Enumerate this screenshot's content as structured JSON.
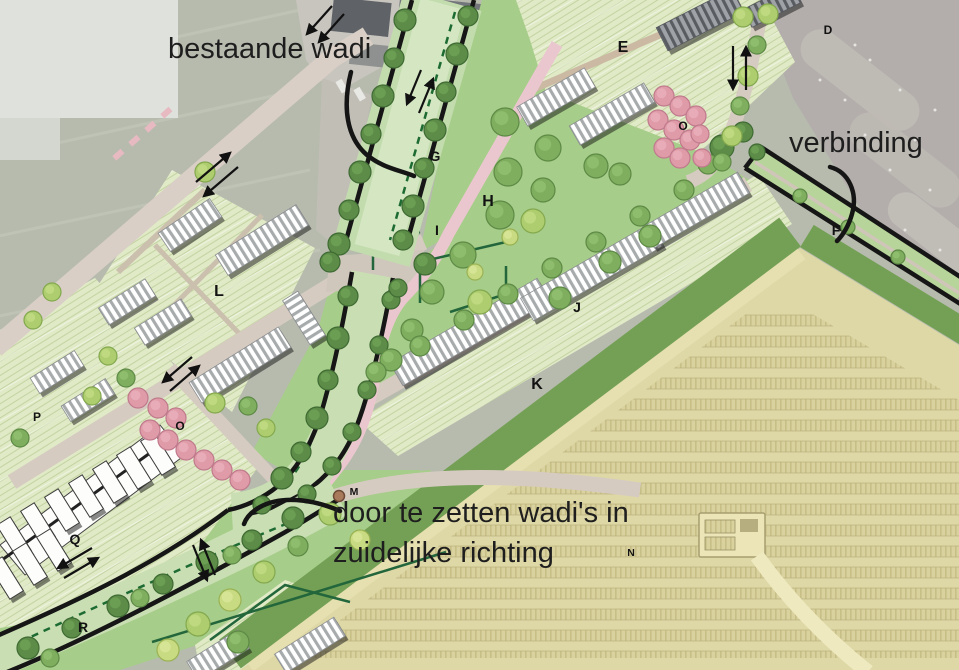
{
  "annotations": {
    "bestaande_wadi": "bestaande wadi",
    "verbinding": "verbinding",
    "door_te_zetten_line1": "door te zetten wadi's in",
    "door_te_zetten_line2": "zuidelijke richting"
  },
  "area_labels": [
    {
      "letter": "D"
    },
    {
      "letter": "E"
    },
    {
      "letter": "O"
    },
    {
      "letter": "G"
    },
    {
      "letter": "H"
    },
    {
      "letter": "I"
    },
    {
      "letter": "F"
    },
    {
      "letter": "J"
    },
    {
      "letter": "K"
    },
    {
      "letter": "L"
    },
    {
      "letter": "P"
    },
    {
      "letter": "O"
    },
    {
      "letter": "Q"
    },
    {
      "letter": "M"
    },
    {
      "letter": "N"
    },
    {
      "letter": "R"
    }
  ],
  "colors": {
    "annotation_ink": "#1e1e1e",
    "label_ink": "#121212",
    "wadi_outline": "#161616",
    "wadi_fill": "#c9dfb3",
    "lawn_green": "#a6cd89",
    "parcel_green": "#e0eac6",
    "field_tan": "#ded8a7",
    "field_row": "#d9d19e",
    "k_strip_green": "#74a055",
    "road_gray": "#d8cec5",
    "path_pink": "#eac7ce",
    "blossom_pink": "#e09aa7",
    "tree_dark": "#5c8c47",
    "tree_mid": "#7fae5f",
    "tree_light": "#aecd6f",
    "aerial_gray": "#b7bbae",
    "parking_gray": "#b3aeab",
    "building_white": "#ffffff"
  }
}
